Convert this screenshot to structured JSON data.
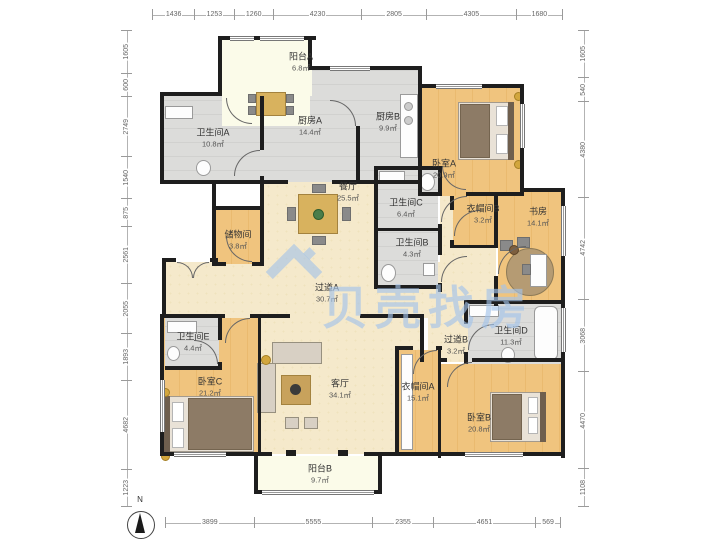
{
  "watermark": {
    "text": "贝壳找房",
    "color": "#a0c1ea"
  },
  "compass": {
    "label": "N"
  },
  "dimensions": {
    "top": [
      "1436",
      "1253",
      "1260",
      "4230",
      "2805",
      "4305",
      "1680"
    ],
    "bottom": [
      "3899",
      "5555",
      "2355",
      "4651",
      "569"
    ],
    "left": [
      "1605",
      "600",
      "2749",
      "1540",
      "875",
      "2561",
      "2055",
      "1893",
      "4682",
      "1223"
    ],
    "right": [
      "1605",
      "540",
      "4380",
      "4742",
      "3068",
      "4470",
      "1108"
    ]
  },
  "rooms": [
    {
      "name": "阳台A",
      "area": "6.8㎡"
    },
    {
      "name": "卫生间A",
      "area": "10.8㎡"
    },
    {
      "name": "厨房A",
      "area": "14.4㎡"
    },
    {
      "name": "厨房B",
      "area": "9.9㎡"
    },
    {
      "name": "卧室A",
      "area": "20.9㎡"
    },
    {
      "name": "餐厅",
      "area": "25.5㎡"
    },
    {
      "name": "卫生间C",
      "area": "6.4㎡"
    },
    {
      "name": "衣帽间B",
      "area": "3.2㎡"
    },
    {
      "name": "书房",
      "area": "14.1㎡"
    },
    {
      "name": "储物间",
      "area": "3.8㎡"
    },
    {
      "name": "卫生间B",
      "area": "4.3㎡"
    },
    {
      "name": "过道A",
      "area": "30.7㎡"
    },
    {
      "name": "卫生间E",
      "area": "4.4㎡"
    },
    {
      "name": "卧室C",
      "area": "21.2㎡"
    },
    {
      "name": "客厅",
      "area": "34.1㎡"
    },
    {
      "name": "衣帽间A",
      "area": "15.1㎡"
    },
    {
      "name": "过道B",
      "area": "3.2㎡"
    },
    {
      "name": "卫生间D",
      "area": "11.3㎡"
    },
    {
      "name": "卧室B",
      "area": "20.8㎡"
    },
    {
      "name": "阳台B",
      "area": "9.7㎡"
    }
  ],
  "colors": {
    "wall": "#1e1e1e",
    "floor_wood": "#efc27d",
    "floor_tile": "#dcdcda",
    "floor_cream": "#f5e9cb",
    "floor_balcony": "#fbfbe9",
    "watermark": "#a0c1ea"
  }
}
